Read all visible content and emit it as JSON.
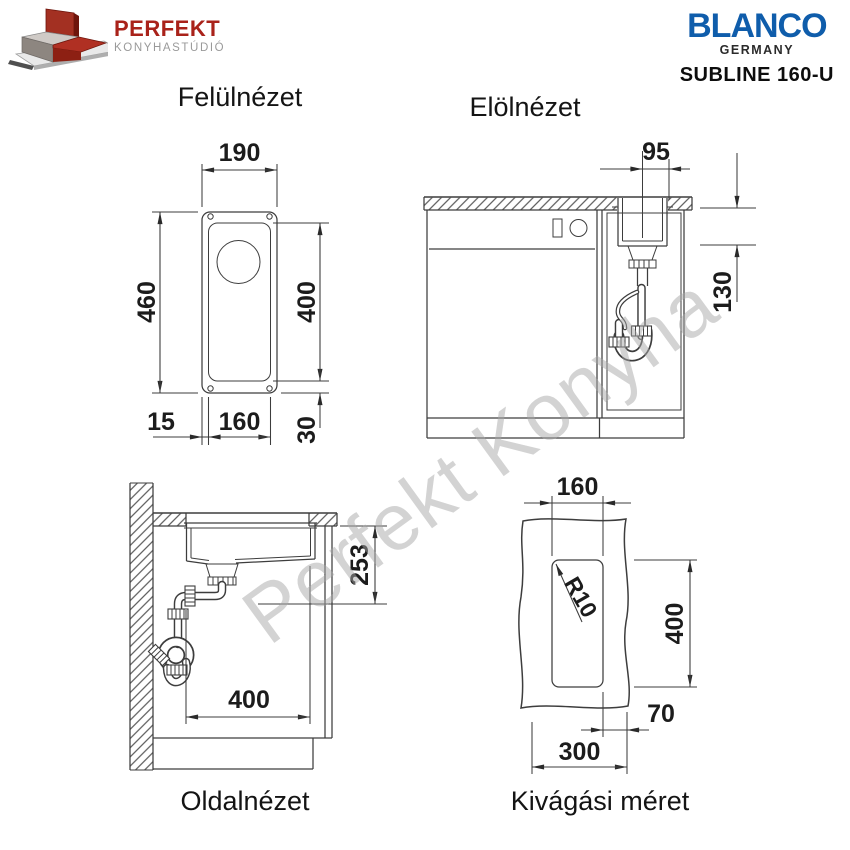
{
  "header": {
    "perfekt": {
      "brand": "PERFEKT",
      "subtitle": "KONYHASTÚDIÓ"
    },
    "blanco": {
      "brand": "BLANCO",
      "country": "GERMANY",
      "model": "SUBLINE 160-U"
    }
  },
  "watermark": "Perfekt Konyha",
  "views": {
    "top": {
      "title": "Felülnézet",
      "dims": {
        "outer_width": "190",
        "outer_length": "460",
        "bowl_length": "400",
        "edge_margin": "15",
        "bowl_width": "160",
        "end_margin": "30"
      }
    },
    "front": {
      "title": "Elölnézet",
      "dims": {
        "center_to_edge": "95",
        "bowl_depth": "130"
      }
    },
    "side": {
      "title": "Oldalnézet",
      "dims": {
        "drain_height": "253",
        "bowl_length": "400"
      }
    },
    "cutout": {
      "title": "Kivágási méret",
      "dims": {
        "width": "160",
        "length": "400",
        "corner_radius": "R10",
        "front_offset": "70",
        "min_width": "300"
      }
    }
  },
  "colors": {
    "blanco_blue": "#0f5dab",
    "perfekt_red": "#a9221a",
    "line_color": "#3d3d3d",
    "watermark_gray": "#d3d3d3"
  }
}
